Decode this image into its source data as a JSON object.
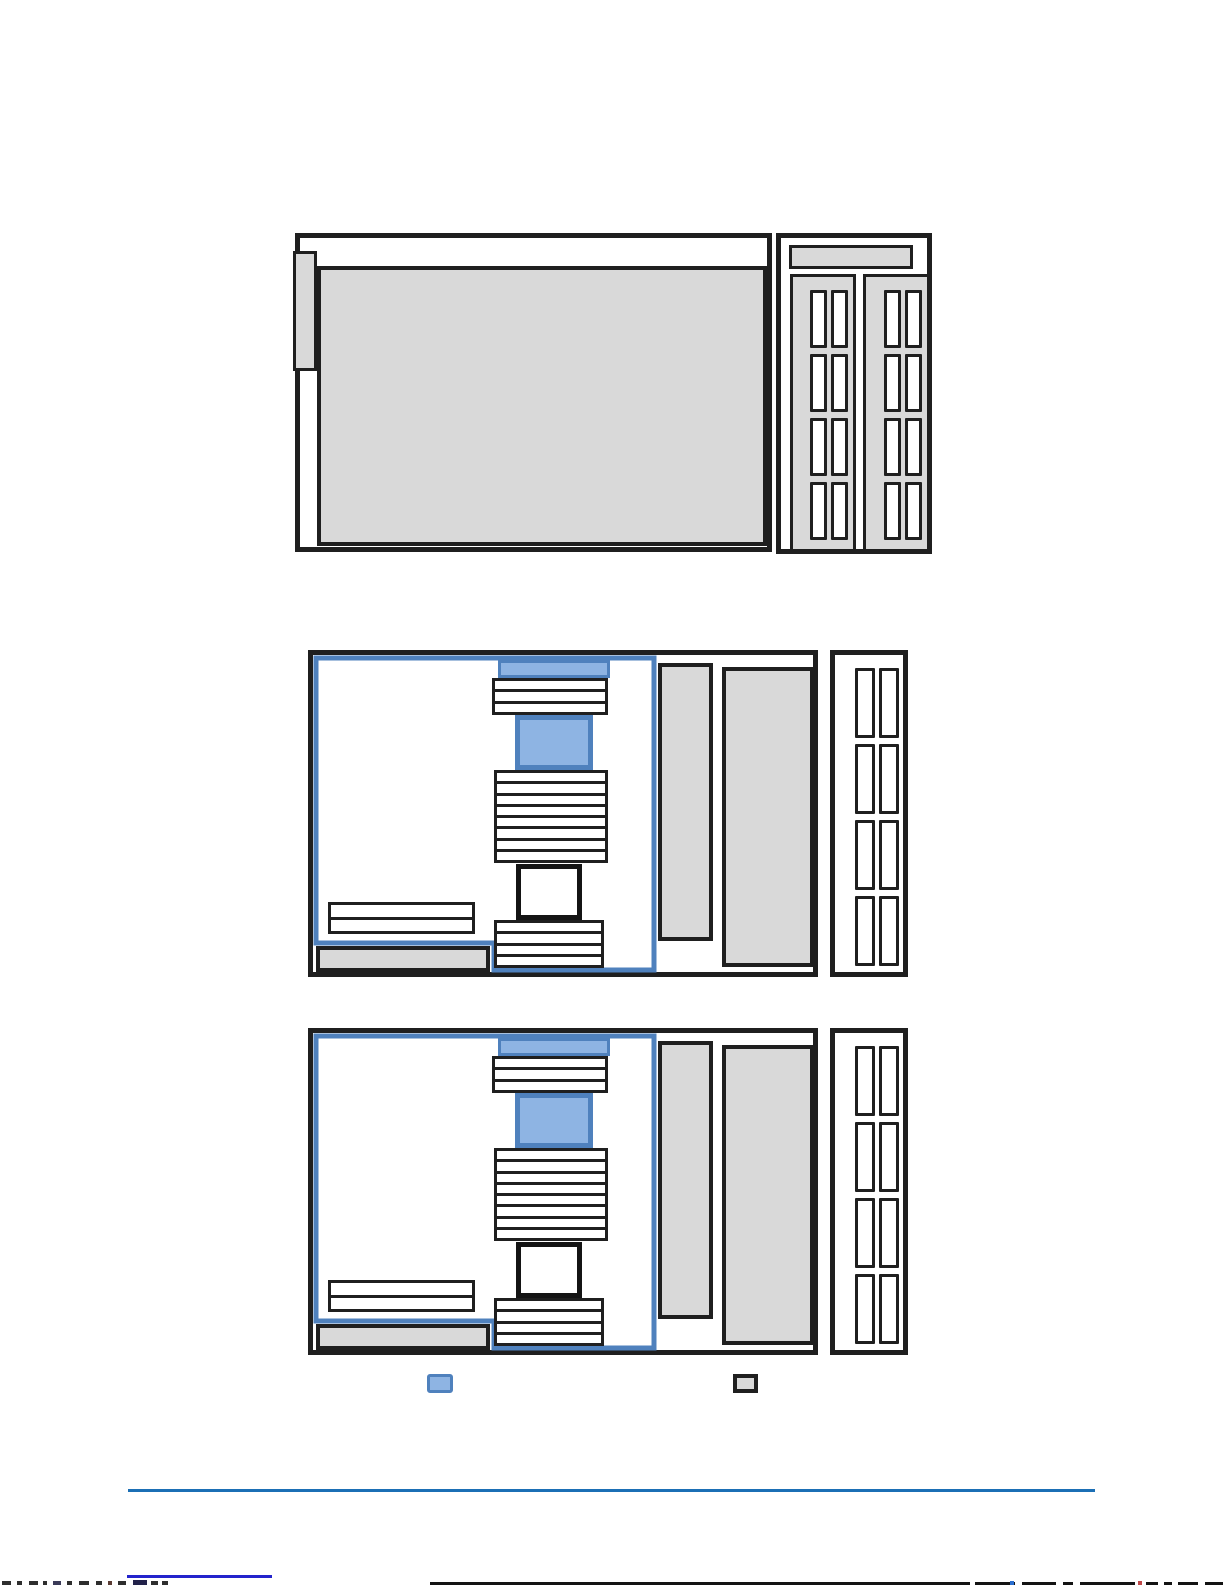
{
  "page": {
    "kind": "hardware-manual-page-with-figures",
    "visible_text": []
  },
  "colors": {
    "line_black": "#1f1f1f",
    "component_gray": "#d9d9d9",
    "highlight_fill": "#8eb4e3",
    "highlight_border": "#4f81bd",
    "footer_rule": "#1b6fb5",
    "clipped_link": "#2323cc"
  },
  "figures": {
    "chassis_overview": {
      "panels": 2,
      "panel_slot_count": 8,
      "has_left_tab": true,
      "has_top_bar": true
    },
    "system_board": {
      "copies": 2,
      "top_stack_slots": 3,
      "middle_stack_slots": 8,
      "bottom_stack_slots": 4,
      "side_stack_slots": 2,
      "rear_bay_slots": 8,
      "highlighted_parts": 2
    }
  },
  "legend": {
    "swatches": [
      {
        "name": "highlight",
        "fill": "#8eb4e3",
        "border": "#4f81bd"
      },
      {
        "name": "component",
        "fill": "#d9d9d9",
        "border": "#1f1f1f"
      }
    ]
  },
  "footer": {
    "rule_color": "#1b6fb5",
    "clipped_text_line": true
  }
}
